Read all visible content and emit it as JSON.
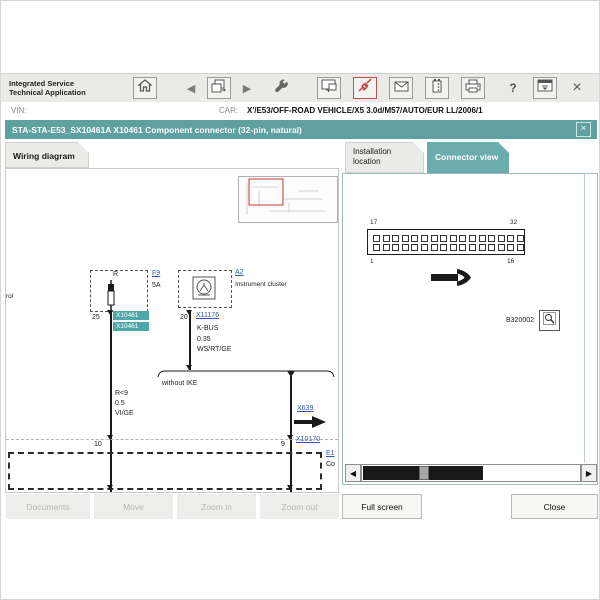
{
  "toolbar": {
    "app_title_line1": "Integrated Service",
    "app_title_line2": "Technical Application",
    "icons": {
      "home": {
        "name": "home-icon"
      },
      "back": {
        "name": "back-icon",
        "glyph": "◀"
      },
      "page_switch": {
        "name": "page-switch-icon"
      },
      "forward": {
        "name": "forward-icon",
        "glyph": "▶"
      },
      "wrench": {
        "name": "wrench-icon"
      },
      "display": {
        "name": "display-icon"
      },
      "connector": {
        "name": "connector-icon",
        "active": true,
        "color": "#c23b3b"
      },
      "mail": {
        "name": "mail-icon"
      },
      "battery": {
        "name": "battery-icon"
      },
      "print": {
        "name": "print-icon"
      },
      "help": {
        "name": "help-icon",
        "glyph": "?"
      },
      "minimize": {
        "name": "minimize-window-icon"
      },
      "close": {
        "name": "close-icon",
        "glyph": "×"
      }
    }
  },
  "vin_bar": {
    "vin_label": "VIN:",
    "car_label": "CAR:",
    "car_value": "X'/E53/OFF-ROAD VEHICLE/X5 3.0d/M57/AUTO/EUR LL/2006/1"
  },
  "title_bar": {
    "title": "STA-STA-E53_SX10461A X10461 Component connector (32-pin, natural)",
    "close_glyph": "×",
    "color": "#5fa1a1"
  },
  "wiring_panel": {
    "tab_label": "Wiring diagram",
    "clipped_edge_text": "rol",
    "fuse": {
      "symbol_top_label": "R",
      "link": "F9",
      "rating": "5A",
      "pin": "25",
      "highlight_labels": [
        "X10461",
        "X10461"
      ],
      "highlight_color": "#4fa8a8"
    },
    "cluster": {
      "link": "A2",
      "label": "Instrument cluster",
      "pin": "20",
      "connector_link": "X11176",
      "wire_labels": [
        "K-BUS",
        "0.35",
        "WS/RT/GE"
      ]
    },
    "branch_label": "without IKE",
    "left_wire_labels": [
      "R<9",
      "0.5",
      "VI/GE"
    ],
    "x639_link": "X639",
    "pin_10": "10",
    "pin_9": "9",
    "x10170_link": "X10170",
    "edge_link": "E1",
    "edge_text": "Co"
  },
  "connector_panel": {
    "tab_installation": "Installation location",
    "tab_connector": "Connector view",
    "pins": {
      "rows": 2,
      "per_row": 16,
      "top_left": "17",
      "top_right": "32",
      "bottom_left": "1",
      "bottom_right": "16"
    },
    "figure_id": "B320002",
    "scrollbar": {
      "left_glyph": "◀",
      "right_glyph": "▶"
    }
  },
  "footer": {
    "left_buttons": [
      {
        "label": "Documents",
        "disabled": true
      },
      {
        "label": "Move",
        "disabled": true
      },
      {
        "label": "Zoom in",
        "disabled": true
      },
      {
        "label": "Zoom out",
        "disabled": true
      }
    ],
    "right_buttons": [
      {
        "label": "Full screen",
        "disabled": false
      },
      {
        "label": "Close",
        "disabled": false
      }
    ]
  },
  "colors": {
    "accent_teal": "#5fa1a1",
    "tab_active_teal": "#6bacac",
    "link_blue": "#3355bb",
    "minimap_highlight_red": "#c0392b",
    "toolbar_bg": "#eaeae7"
  }
}
